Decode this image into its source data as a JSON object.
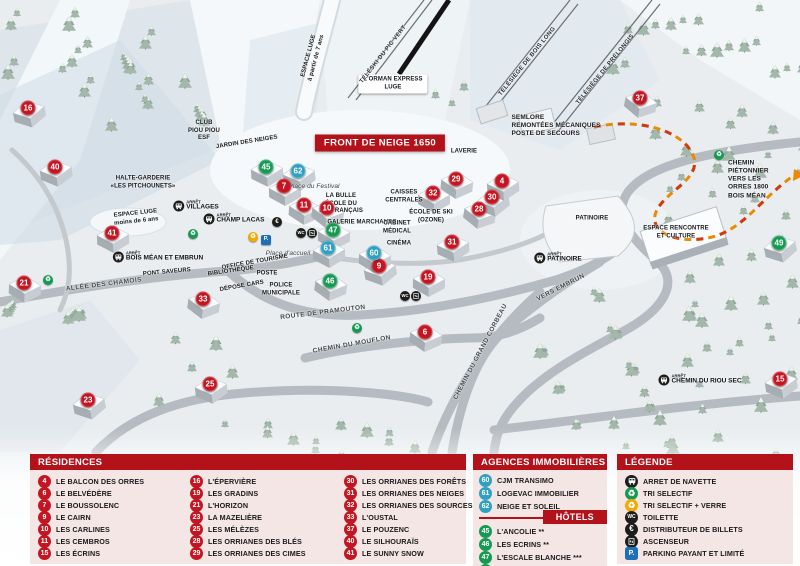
{
  "map": {
    "banner": "FRONT DE NEIGE 1650",
    "bus_stop_prefix": "ARRÊT",
    "labels": [
      {
        "t": "L'ORMAN EXPRESS\nLUGE",
        "x": 393,
        "y": 84,
        "cls": "plaque"
      },
      {
        "t": "TÉLÉSKI DU PIC VERT",
        "x": 384,
        "y": 55,
        "r": -52,
        "cls": "lift"
      },
      {
        "t": "TÉLÉSIÈGE DE BOIS LONG",
        "x": 528,
        "y": 62,
        "r": -51,
        "cls": "lift"
      },
      {
        "t": "TÉLÉSIÈGE DE PRÉLONGIS",
        "x": 606,
        "y": 70,
        "r": -51,
        "cls": "lift"
      },
      {
        "t": "SEMLORE\nREMONTÉES MÉCANIQUES\nPOSTE DE SECOURS",
        "x": 556,
        "y": 126,
        "cls": "left"
      },
      {
        "t": "ESPACE LUGE\nà partir de 7 ans",
        "x": 313,
        "y": 57,
        "r": -75,
        "cls": "tiny"
      },
      {
        "t": "ESPACE LUGE\nmoins de 6 ans",
        "x": 136,
        "y": 218,
        "r": -6,
        "cls": "tiny"
      },
      {
        "t": "CLUB\nPIOU PIOU\nESF",
        "x": 204,
        "y": 131,
        "cls": "tiny"
      },
      {
        "t": "JARDIN DES NEIGES",
        "x": 247,
        "y": 143,
        "r": -9,
        "cls": "tiny"
      },
      {
        "t": "HALTE-GARDERIE\n«LES PITCHOUNETS»",
        "x": 143,
        "y": 183,
        "cls": "tiny"
      },
      {
        "t": "LA BULLE\nÉCOLE DU\nSKI FRANÇAIS",
        "x": 341,
        "y": 204,
        "cls": "tiny"
      },
      {
        "t": "GALERIE MARCHANDE",
        "x": 362,
        "y": 223,
        "cls": "tiny"
      },
      {
        "t": "CAISSES\nCENTRALES",
        "x": 404,
        "y": 197,
        "cls": "tiny"
      },
      {
        "t": "LAVERIE",
        "x": 464,
        "y": 152,
        "cls": "tiny"
      },
      {
        "t": "ÉCOLE DE SKI\n(OZONE)",
        "x": 431,
        "y": 217,
        "cls": "tiny"
      },
      {
        "t": "CABINET\nMÉDICAL",
        "x": 397,
        "y": 228,
        "cls": "tiny"
      },
      {
        "t": "CINÉMA",
        "x": 399,
        "y": 244,
        "cls": "tiny"
      },
      {
        "t": "Place du Festival",
        "x": 314,
        "y": 187,
        "cls": "italic"
      },
      {
        "t": "Place d'accueil",
        "x": 288,
        "y": 254,
        "cls": "italic"
      },
      {
        "t": "OFFICE DE TOURISME",
        "x": 255,
        "y": 263,
        "r": -10,
        "cls": "tiny"
      },
      {
        "t": "BIBLIOTHÈQUE",
        "x": 231,
        "y": 272,
        "r": -8,
        "cls": "tiny"
      },
      {
        "t": "POSTE",
        "x": 267,
        "y": 274,
        "cls": "tiny"
      },
      {
        "t": "POLICE\nMUNICIPALE",
        "x": 281,
        "y": 290,
        "cls": "tiny"
      },
      {
        "t": "DÉPOSE CARS",
        "x": 242,
        "y": 287,
        "r": -10,
        "cls": "tiny"
      },
      {
        "t": "PONT SAVEURS",
        "x": 167,
        "y": 273,
        "r": -5,
        "cls": "tiny"
      },
      {
        "t": "ALLÉE DES CHAMOIS",
        "x": 104,
        "y": 285,
        "r": -7,
        "cls": "road"
      },
      {
        "t": "ROUTE DE PRAMOUTON",
        "x": 323,
        "y": 313,
        "r": -7,
        "cls": "road"
      },
      {
        "t": "CHEMIN DU MOUFLON",
        "x": 352,
        "y": 345,
        "r": -10,
        "cls": "road"
      },
      {
        "t": "CHEMIN DU GRAND CORBEAU",
        "x": 481,
        "y": 352,
        "r": -62,
        "cls": "road"
      },
      {
        "t": "VERS EMBRUN",
        "x": 561,
        "y": 288,
        "r": -27,
        "cls": "road"
      },
      {
        "t": "PATINOIRE",
        "x": 592,
        "y": 219,
        "cls": "tiny"
      },
      {
        "t": "ESPACE RENCONTRE\nET CULTURE",
        "x": 676,
        "y": 233,
        "cls": "tiny"
      },
      {
        "t": "CHEMIN PIÉTONNIER\nVERS LES ORRES 1800\nBOIS MÉAN",
        "x": 752,
        "y": 180,
        "cls": "left"
      }
    ],
    "bus_stops": [
      {
        "name": "VILLAGES",
        "x": 196,
        "y": 206
      },
      {
        "name": "CHAMP LACAS",
        "x": 234,
        "y": 219
      },
      {
        "name": "BOIS MÉAN ET EMBRUN",
        "x": 158,
        "y": 257
      },
      {
        "name": "PATINOIRE",
        "x": 558,
        "y": 258
      },
      {
        "name": "CHEMIN DU RIOU SEC",
        "x": 700,
        "y": 380
      }
    ],
    "mini_icons": [
      {
        "k": "recycle-green",
        "x": 193,
        "y": 234
      },
      {
        "k": "recycle-green",
        "x": 48,
        "y": 280
      },
      {
        "k": "recycle-green",
        "x": 357,
        "y": 328
      },
      {
        "k": "recycle-green",
        "x": 719,
        "y": 155
      },
      {
        "k": "recycle-orange",
        "x": 253,
        "y": 237
      },
      {
        "k": "parking",
        "x": 266,
        "y": 240
      },
      {
        "k": "euro",
        "x": 277,
        "y": 222
      },
      {
        "k": "wc",
        "x": 301,
        "y": 233
      },
      {
        "k": "ascenseur",
        "x": 312,
        "y": 233
      },
      {
        "k": "wc",
        "x": 405,
        "y": 296
      },
      {
        "k": "ascenseur",
        "x": 416,
        "y": 296
      }
    ],
    "markers": [
      {
        "n": 16,
        "c": "r",
        "x": 28,
        "y": 108
      },
      {
        "n": 40,
        "c": "r",
        "x": 55,
        "y": 167
      },
      {
        "n": 41,
        "c": "r",
        "x": 112,
        "y": 233
      },
      {
        "n": 21,
        "c": "r",
        "x": 24,
        "y": 283
      },
      {
        "n": 33,
        "c": "r",
        "x": 203,
        "y": 299
      },
      {
        "n": 23,
        "c": "r",
        "x": 88,
        "y": 400
      },
      {
        "n": 25,
        "c": "r",
        "x": 210,
        "y": 384
      },
      {
        "n": 7,
        "c": "r",
        "x": 284,
        "y": 186
      },
      {
        "n": 11,
        "c": "r",
        "x": 304,
        "y": 205
      },
      {
        "n": 10,
        "c": "r",
        "x": 327,
        "y": 208
      },
      {
        "n": 9,
        "c": "r",
        "x": 379,
        "y": 266
      },
      {
        "n": 31,
        "c": "r",
        "x": 452,
        "y": 242
      },
      {
        "n": 32,
        "c": "r",
        "x": 433,
        "y": 193
      },
      {
        "n": 29,
        "c": "r",
        "x": 456,
        "y": 179
      },
      {
        "n": 28,
        "c": "r",
        "x": 479,
        "y": 209
      },
      {
        "n": 30,
        "c": "r",
        "x": 492,
        "y": 197
      },
      {
        "n": 4,
        "c": "r",
        "x": 502,
        "y": 181
      },
      {
        "n": 19,
        "c": "r",
        "x": 428,
        "y": 277
      },
      {
        "n": 6,
        "c": "r",
        "x": 425,
        "y": 332
      },
      {
        "n": 37,
        "c": "r",
        "x": 640,
        "y": 98
      },
      {
        "n": 15,
        "c": "r",
        "x": 780,
        "y": 379
      },
      {
        "n": 45,
        "c": "g",
        "x": 266,
        "y": 167
      },
      {
        "n": 47,
        "c": "g",
        "x": 333,
        "y": 230
      },
      {
        "n": 46,
        "c": "g",
        "x": 330,
        "y": 281
      },
      {
        "n": 49,
        "c": "g",
        "x": 779,
        "y": 243
      },
      {
        "n": 62,
        "c": "b",
        "x": 298,
        "y": 171
      },
      {
        "n": 61,
        "c": "b",
        "x": 328,
        "y": 248
      },
      {
        "n": 60,
        "c": "b",
        "x": 374,
        "y": 253
      }
    ]
  },
  "legend": {
    "residences": {
      "title": "RÉSIDENCES",
      "items": [
        {
          "n": 4,
          "label": "LE BALCON DES ORRES"
        },
        {
          "n": 6,
          "label": "LE BELVÉDÈRE"
        },
        {
          "n": 7,
          "label": "LE BOUSSOLENC"
        },
        {
          "n": 9,
          "label": "LE CAIRN"
        },
        {
          "n": 10,
          "label": "LES CARLINES"
        },
        {
          "n": 11,
          "label": "LES CEMBROS"
        },
        {
          "n": 15,
          "label": "LES ÉCRINS"
        },
        {
          "n": 16,
          "label": "L'ÉPERVIÈRE"
        },
        {
          "n": 19,
          "label": "LES GRADINS"
        },
        {
          "n": 21,
          "label": "L'HORIZON"
        },
        {
          "n": 23,
          "label": "LA MAZELIÈRE"
        },
        {
          "n": 25,
          "label": "LES MÉLÈZES"
        },
        {
          "n": 28,
          "label": "LES ORRIANES DES BLÉS"
        },
        {
          "n": 29,
          "label": "LES ORRIANES DES CIMES"
        },
        {
          "n": 30,
          "label": "LES ORRIANES DES FORÊTS"
        },
        {
          "n": 31,
          "label": "LES ORRIANES DES NEIGES"
        },
        {
          "n": 32,
          "label": "LES ORRIANES DES SOURCES"
        },
        {
          "n": 33,
          "label": "L'OUSTAL"
        },
        {
          "n": 37,
          "label": "LE POUZENC"
        },
        {
          "n": 40,
          "label": "LE SILHOURAÏS"
        },
        {
          "n": 41,
          "label": "LE SUNNY SNOW"
        }
      ]
    },
    "agences": {
      "title": "AGENCES IMMOBILIÈRES",
      "items": [
        {
          "n": 60,
          "label": "CJM TRANSIMO"
        },
        {
          "n": 61,
          "label": "LOGEVAC IMMOBILIER"
        },
        {
          "n": 62,
          "label": "NEIGE ET SOLEIL"
        }
      ]
    },
    "hotels": {
      "title": "HÔTELS",
      "items": [
        {
          "n": 45,
          "label": "L'ANCOLIE **"
        },
        {
          "n": 46,
          "label": "LES ECRINS **"
        },
        {
          "n": 47,
          "label": "L'ESCALE BLANCHE ***"
        },
        {
          "n": 49,
          "label": "LES TRAPPEURS **"
        }
      ]
    },
    "legende": {
      "title": "LÉGENDE",
      "items": [
        {
          "icon": "bus",
          "label": "ARRET DE NAVETTE"
        },
        {
          "icon": "recycle-green",
          "label": "TRI SELECTIF"
        },
        {
          "icon": "recycle-orange",
          "label": "TRI SELECTIF + VERRE"
        },
        {
          "icon": "wc",
          "label": "TOILETTE"
        },
        {
          "icon": "euro",
          "label": "DISTRIBUTEUR DE BILLETS"
        },
        {
          "icon": "ascenseur",
          "label": "ASCENSEUR"
        },
        {
          "icon": "parking",
          "label": "PARKING PAYANT ET LIMITÉ"
        }
      ]
    }
  },
  "colors": {
    "header_red": "#b3121a",
    "marker_red": "#c31522",
    "hotel_green": "#159a52",
    "agency_blue": "#2fa0bf",
    "recycle_orange": "#f2a900",
    "parking_blue": "#1e6fb8",
    "icon_dark": "#1d1d1b"
  }
}
